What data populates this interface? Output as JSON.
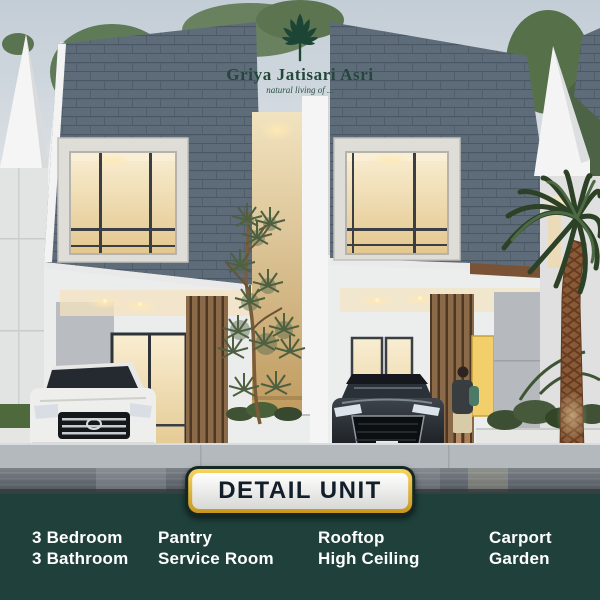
{
  "logo": {
    "brand": "Griya Jatisari Asri",
    "tagline": "natural living of ...",
    "icon": "lotus-leaves-icon"
  },
  "cta": {
    "label": "DETAIL UNIT"
  },
  "features": {
    "columns": [
      {
        "lines": [
          "3 Bedroom",
          "3 Bathroom"
        ]
      },
      {
        "lines": [
          "Pantry",
          "Service Room"
        ]
      },
      {
        "lines": [
          "Rooftop",
          "High Ceiling"
        ]
      },
      {
        "lines": [
          "Carport",
          "Garden"
        ]
      }
    ]
  },
  "scene_elements": [
    "left-house",
    "right-house",
    "white-suv",
    "dark-sedan",
    "palm-tree",
    "center-tree",
    "person",
    "street"
  ],
  "colors": {
    "band_teal": "#1f403b",
    "gold_border": "#e8b83c",
    "brand_green": "#23473a",
    "roof_slate": "#5e6c7b",
    "warm_window_light": "#f2ddae",
    "button_text": "#121f2b",
    "feature_text": "#ffffff"
  }
}
